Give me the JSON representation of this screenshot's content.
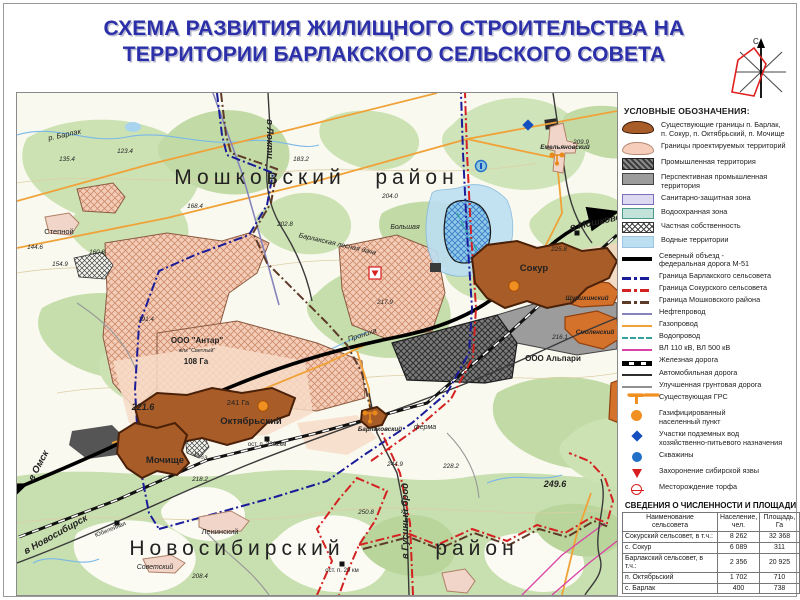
{
  "title": {
    "line1": "СХЕМА РАЗВИТИЯ ЖИЛИЩНОГО СТРОИТЕЛЬСТВА НА",
    "line2": "ТЕРРИТОРИИ БАРЛАКСКОГО СЕЛЬСКОГО СОВЕТА"
  },
  "compass": {
    "north_label": "С"
  },
  "colors": {
    "title_blue": "#2B2FA8",
    "boundary_blue": "#1A1C9A",
    "boundary_red": "#D42222",
    "boundary_district": "#5E3A28",
    "gas_orange": "#F0A238",
    "oil_purple": "#8585BC",
    "water_pipe_teal": "#35A0A0",
    "power_magenta": "#D843A5",
    "settlement_brown": "#A85C28",
    "project_pink": "#F4CDB8",
    "industrial_gray": "#777777",
    "water_blue": "#BCDFF2",
    "grs_orange": "#F09020",
    "well_blue": "#2070C8",
    "diamond_blue": "#1550C0",
    "anthrax_red": "#D81E1E"
  },
  "legend": {
    "heading": "УСЛОВНЫЕ ОБОЗНАЧЕНИЯ:",
    "items": [
      {
        "swatch": "a-exist",
        "label": "Существующие границы п. Барлак,\nп. Сокур, п. Октябрьский, п. Мочище"
      },
      {
        "swatch": "a-proj",
        "label": "Границы проектируемых территорий"
      },
      {
        "swatch": "a-ind",
        "label": "Промышленная территория"
      },
      {
        "swatch": "a-pind",
        "label": "Перспективная промышленная\nтерритория"
      },
      {
        "swatch": "a-san",
        "label": "Санитарно-защитная зона"
      },
      {
        "swatch": "a-wprot",
        "label": "Водоохранная зона"
      },
      {
        "swatch": "a-priv",
        "label": "Частная собственность"
      },
      {
        "swatch": "a-wat",
        "label": "Водные территории"
      },
      {
        "swatch": "l-m51",
        "label": "Северный объезд -\nфедеральная дорога М-51"
      },
      {
        "swatch": "l-bblue",
        "label": "Граница Барлакского сельсовета"
      },
      {
        "swatch": "l-bred",
        "label": "Граница Сокурского сельсовета"
      },
      {
        "swatch": "l-bdist",
        "label": "Граница Мошковского района"
      },
      {
        "swatch": "l-oil",
        "label": "Нефтепровод"
      },
      {
        "swatch": "l-gas",
        "label": "Газопровод"
      },
      {
        "swatch": "l-wpipe",
        "label": "Водопровод"
      },
      {
        "swatch": "l-power",
        "label": "ВЛ 110 кВ, ВЛ 500 кВ"
      },
      {
        "swatch": "l-rail",
        "label": "Железная дорога"
      },
      {
        "swatch": "l-road",
        "label": "Автомобильная дорога"
      },
      {
        "swatch": "l-dirt",
        "label": "Улучшенная грунтовая дорога"
      },
      {
        "swatch": "s-grs",
        "label": "Существующая ГРС"
      },
      {
        "swatch": "s-gastown",
        "label": "Газифицированный\nнаселенный пункт"
      },
      {
        "swatch": "s-uwater",
        "label": "Участки подземных вод\nхозяйственно-питьевого назначения"
      },
      {
        "swatch": "s-well",
        "label": "Скважины"
      },
      {
        "swatch": "s-anthrax",
        "label": "Захоронение сибирской язвы"
      },
      {
        "swatch": "s-peat",
        "label": "Месторождение торфа"
      }
    ]
  },
  "table": {
    "title": "СВЕДЕНИЯ О ЧИСЛЕННОСТИ И ПЛОЩАДИ",
    "headers": [
      "Наименование\nсельсовета",
      "Население,\nчел.",
      "Площадь,\nГа"
    ],
    "rows": [
      [
        "Сокурский сельсовет, в т.ч.:",
        "8 262",
        "32 368"
      ],
      [
        "с. Сокур",
        "6 089",
        "311"
      ],
      [
        "Барлакский сельсовет, в т.ч.:",
        "2 356",
        "20 925"
      ],
      [
        "п. Октябрьский",
        "1 702",
        "710"
      ],
      [
        "с. Барлак",
        "400",
        "738"
      ]
    ]
  },
  "map": {
    "labels": [
      {
        "t": "Мошковский",
        "x": 243,
        "y": 91,
        "c": "d"
      },
      {
        "t": "район",
        "x": 400,
        "y": 91,
        "c": "d"
      },
      {
        "t": "Новосибирский",
        "x": 220,
        "y": 462,
        "c": "d"
      },
      {
        "t": "район",
        "x": 460,
        "y": 462,
        "c": "d"
      },
      {
        "t": "Сокур",
        "x": 517,
        "y": 178,
        "c": "set"
      },
      {
        "t": "Октябрьский",
        "x": 234,
        "y": 331,
        "c": "set"
      },
      {
        "t": "Мочище",
        "x": 148,
        "y": 370,
        "c": "set"
      },
      {
        "t": "Емельяновский",
        "x": 548,
        "y": 56,
        "c": "set2"
      },
      {
        "t": "Щурихинский",
        "x": 570,
        "y": 207,
        "c": "set2"
      },
      {
        "t": "Смоленский",
        "x": 578,
        "y": 241,
        "c": "set2"
      },
      {
        "t": "Барлаковский",
        "x": 363,
        "y": 338,
        "c": "set2"
      },
      {
        "t": "Ленинский",
        "x": 203,
        "y": 441,
        "c": "gray"
      },
      {
        "t": "Советский",
        "x": 138,
        "y": 476,
        "c": "topo"
      },
      {
        "t": "Степной",
        "x": 42,
        "y": 141,
        "c": "gray"
      },
      {
        "t": "ферма",
        "x": 408,
        "y": 336,
        "c": "topo"
      },
      {
        "t": "р. Барлак",
        "x": 48,
        "y": 44,
        "c": "hyd",
        "r": -12
      },
      {
        "t": "Прониха",
        "x": 346,
        "y": 244,
        "c": "hyd",
        "r": -18
      },
      {
        "t": "Большая",
        "x": 388,
        "y": 136,
        "c": "topo"
      },
      {
        "t": "Барлакская лесная дача",
        "x": 320,
        "y": 153,
        "c": "topo",
        "r": 13
      },
      {
        "t": "в Омск",
        "x": 24,
        "y": 374,
        "c": "dir",
        "r": -62
      },
      {
        "t": "в Новосибирск",
        "x": 40,
        "y": 444,
        "c": "dir",
        "r": -29
      },
      {
        "t": "в Локти",
        "x": 250,
        "y": 46,
        "c": "dir",
        "r": 90
      },
      {
        "t": "в Мошково",
        "x": 579,
        "y": 132,
        "c": "dir",
        "r": -12
      },
      {
        "t": "в Гусиный брод",
        "x": 391,
        "y": 428,
        "c": "dir",
        "r": -90
      },
      {
        "t": "М-53",
        "x": 183,
        "y": 365,
        "c": "stop",
        "r": 18
      },
      {
        "t": "ООО \"Антар\"",
        "x": 180,
        "y": 250,
        "c": "area"
      },
      {
        "t": "ж/м \"Светлый\"",
        "x": 180,
        "y": 259,
        "c": "areasm"
      },
      {
        "t": "108 Га",
        "x": 179,
        "y": 271,
        "c": "area"
      },
      {
        "t": "241 Га",
        "x": 221,
        "y": 312,
        "c": "gray"
      },
      {
        "t": "ООО Альпари",
        "x": 536,
        "y": 268,
        "c": "area"
      },
      {
        "t": "ост. п. 3362км",
        "x": 250,
        "y": 353,
        "c": "stop"
      },
      {
        "t": "ост. п. 29 км",
        "x": 325,
        "y": 479,
        "c": "stop"
      },
      {
        "t": "Юбилейная",
        "x": 94,
        "y": 438,
        "c": "stop",
        "r": -22
      },
      {
        "t": "221.6",
        "x": 126,
        "y": 317,
        "c": "elevlg"
      },
      {
        "t": "249.6",
        "x": 538,
        "y": 394,
        "c": "elevlg"
      },
      {
        "t": "135.4",
        "x": 50,
        "y": 68,
        "c": "elev"
      },
      {
        "t": "123.4",
        "x": 108,
        "y": 60,
        "c": "elev"
      },
      {
        "t": "183.2",
        "x": 284,
        "y": 68,
        "c": "elev"
      },
      {
        "t": "144.6",
        "x": 18,
        "y": 156,
        "c": "elev"
      },
      {
        "t": "160.8",
        "x": 80,
        "y": 161,
        "c": "elev"
      },
      {
        "t": "154.9",
        "x": 43,
        "y": 173,
        "c": "elev"
      },
      {
        "t": "191.4",
        "x": 129,
        "y": 228,
        "c": "elev"
      },
      {
        "t": "204.0",
        "x": 373,
        "y": 105,
        "c": "elev"
      },
      {
        "t": "209.9",
        "x": 564,
        "y": 51,
        "c": "elev"
      },
      {
        "t": "225.8",
        "x": 542,
        "y": 158,
        "c": "elev"
      },
      {
        "t": "216.1",
        "x": 543,
        "y": 246,
        "c": "elev"
      },
      {
        "t": "217.9",
        "x": 368,
        "y": 211,
        "c": "elev"
      },
      {
        "t": "218.2",
        "x": 183,
        "y": 388,
        "c": "elev"
      },
      {
        "t": "244.9",
        "x": 378,
        "y": 373,
        "c": "elev"
      },
      {
        "t": "228.2",
        "x": 434,
        "y": 375,
        "c": "elev"
      },
      {
        "t": "250.8",
        "x": 349,
        "y": 421,
        "c": "elev"
      },
      {
        "t": "208.4",
        "x": 183,
        "y": 485,
        "c": "elev"
      },
      {
        "t": "168.4",
        "x": 178,
        "y": 115,
        "c": "elev"
      },
      {
        "t": "202.8",
        "x": 268,
        "y": 133,
        "c": "elev"
      }
    ],
    "symbols": [
      {
        "type": "gas",
        "x": 497,
        "y": 193
      },
      {
        "type": "gas",
        "x": 246,
        "y": 313
      },
      {
        "type": "grs",
        "x": 540,
        "y": 66
      },
      {
        "type": "grs",
        "x": 353,
        "y": 324
      },
      {
        "type": "well",
        "x": 464,
        "y": 73
      },
      {
        "type": "diamond",
        "x": 511,
        "y": 32
      },
      {
        "type": "anthrax",
        "x": 358,
        "y": 180
      },
      {
        "type": "halt",
        "x": 100,
        "y": 430
      },
      {
        "type": "halt",
        "x": 250,
        "y": 346
      },
      {
        "type": "halt",
        "x": 325,
        "y": 471
      },
      {
        "type": "halt",
        "x": 560,
        "y": 140
      }
    ]
  }
}
